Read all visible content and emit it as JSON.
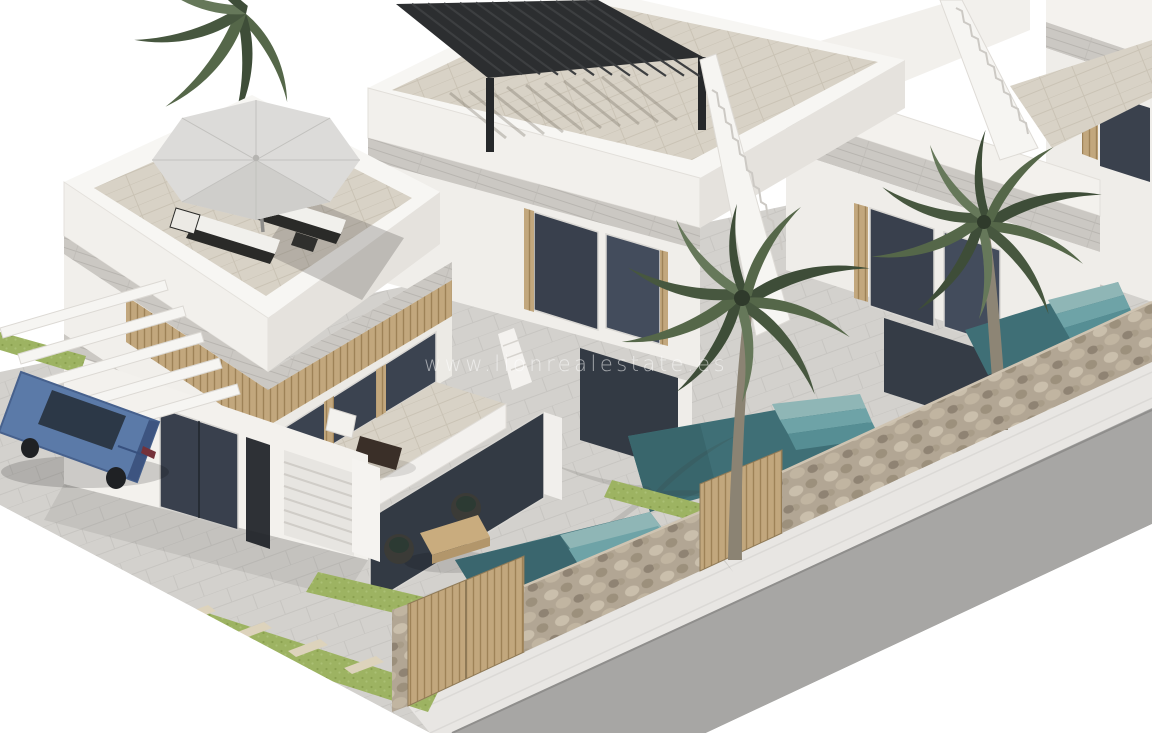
{
  "meta": {
    "type": "3d-architectural-render",
    "subject": "Row of modern white terraced villas with private plunge pools, rooftop terraces and palm trees",
    "background": "#ffffff"
  },
  "watermark": {
    "text": "www.lionrealestate.es",
    "color": "#ffffff",
    "opacity": 0.55
  },
  "scene": {
    "description": "Aerial three-quarter CGI view of new-build villas along a street; nearest villa has a rooftop solarium with parasol and two sun loungers, a first-floor terrace with table and chairs, a garage, a carport of white beams over a blue sedan and a covered ground-floor terrace with rattan chairs; the second villa has a black louvered pergola on its roof terrace; each villa has an external white staircase, a walled front garden with a tiled plunge pool, lawn strips with stepping stones, wooden slatted gates in a natural stone wall, palm trees, and a grey asphalt road with white sidewalk in front.",
    "villas_count": 4,
    "objects": [
      {
        "name": "villa-left",
        "features": [
          "rooftop solarium",
          "parasol",
          "two sun loungers",
          "first-floor terrace with bistro set",
          "wood-slat facade band",
          "garage door",
          "entrance door",
          "glass sliders",
          "white carport beams",
          "covered terrace with rattan chairs and coffee table"
        ]
      },
      {
        "name": "villa-middle",
        "features": [
          "black louvered roof pergola",
          "external white staircase",
          "glass doors with wood posts",
          "plunge pool with steps"
        ]
      },
      {
        "name": "villa-right",
        "features": [
          "external white staircase",
          "glass doors with wood posts",
          "plunge pool with steps",
          "palm tree in garden"
        ]
      },
      {
        "name": "villa-far-right-partial",
        "features": [
          "edge of facade with dark window and wood slats"
        ]
      },
      {
        "name": "blue-sedan-car",
        "color": "#5b7aa8"
      },
      {
        "name": "palm-trees",
        "count": 3
      },
      {
        "name": "stone-perimeter-wall"
      },
      {
        "name": "wooden-slatted-gates",
        "count": 2
      },
      {
        "name": "plunge-pools",
        "count": 3
      },
      {
        "name": "lawn-with-stepping-stones"
      },
      {
        "name": "street-and-sidewalk"
      }
    ],
    "palette": {
      "wall_lit": "#f6f5f2",
      "wall_mid": "#eceae6",
      "wall_shaded": "#dedbd6",
      "fascia_travertine": "#cbc8c3",
      "glass_dark": "#39404d",
      "glass_light": "#4b5568",
      "wood_slat": "#c2a77d",
      "stone_wall": "#b4a896",
      "pool_deep": "#3f6f76",
      "pool_steps_light": "#8fb6b6",
      "grass": "#9db362",
      "paving": "#d3d1cd",
      "terrace_tile": "#d8d2c6",
      "road": "#a7a6a4",
      "sidewalk": "#e8e6e3",
      "car_blue": "#5b7aa8",
      "pergola_black": "#2c2e30",
      "palm_green": "#4c5c42",
      "palm_trunk": "#8b8373",
      "parasol_grey": "#dbdad8"
    }
  }
}
